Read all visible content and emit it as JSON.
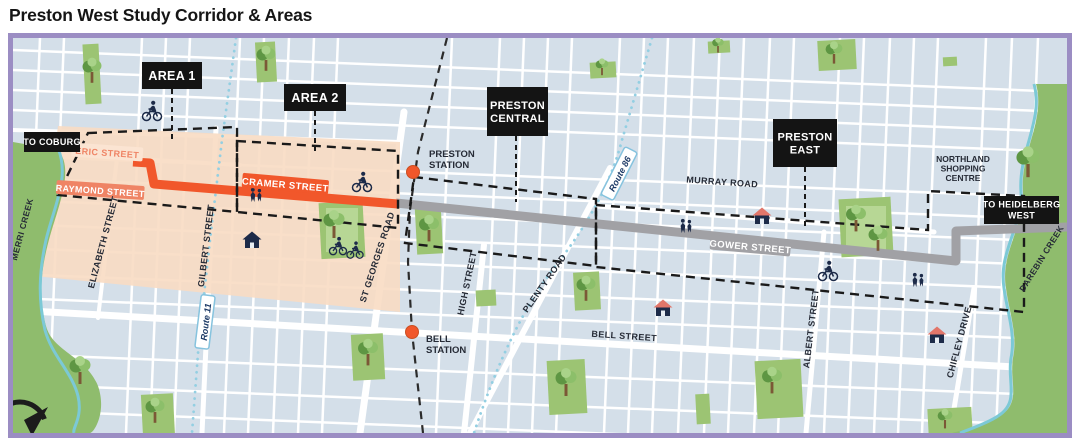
{
  "title": "Preston West Study Corridor & Areas",
  "theme": {
    "map_border": "#9b8dc3",
    "map_background": "#d4dfe9",
    "street_white": "#ffffff",
    "study_area_peach": "#f8dcc3",
    "corridor_orange": "#f1572b",
    "corridor_gray": "#a1a1a5",
    "park_green": "#9cc473",
    "park_green_light": "#b7d795",
    "creek_teal": "#7cc9d6",
    "label_box_bg": "#141414",
    "label_box_text": "#ffffff",
    "street_label_text": "#262b36",
    "route_label_text": "#1d3a66",
    "route_pill_border": "#86c3de",
    "station_dot": "#f1572b",
    "icon_navy": "#1d2b49"
  },
  "map": {
    "boxes": [
      {
        "name": "area-1-label",
        "lines": [
          "AREA 1"
        ],
        "x": 142,
        "y": 62,
        "w": 60,
        "h": 27,
        "fs": 12.5,
        "leader": [
          172,
          89,
          172,
          140
        ]
      },
      {
        "name": "area-2-label",
        "lines": [
          "AREA 2"
        ],
        "x": 284,
        "y": 84,
        "w": 62,
        "h": 27,
        "fs": 12.5,
        "leader": [
          315,
          111,
          315,
          151
        ]
      },
      {
        "name": "preston-central-label",
        "lines": [
          "PRESTON",
          "CENTRAL"
        ],
        "x": 487,
        "y": 87,
        "w": 61,
        "h": 49,
        "fs": 11,
        "leader": [
          516,
          136,
          516,
          202
        ]
      },
      {
        "name": "preston-east-label",
        "lines": [
          "PRESTON",
          "EAST"
        ],
        "x": 773,
        "y": 119,
        "w": 64,
        "h": 48,
        "fs": 11,
        "leader": [
          805,
          167,
          805,
          228
        ]
      },
      {
        "name": "to-coburg-label",
        "lines": [
          "TO COBURG"
        ],
        "x": 24,
        "y": 132,
        "w": 56,
        "h": 20,
        "fs": 9
      },
      {
        "name": "to-heidelberg-west-label",
        "lines": [
          "TO HEIDELBERG",
          "WEST"
        ],
        "x": 984,
        "y": 196,
        "w": 75,
        "h": 28,
        "fs": 9
      }
    ],
    "street_labels": [
      {
        "name": "eric-street-label",
        "text": "ERIC STREET",
        "x": 107,
        "y": 156,
        "rot": 4,
        "style": "orangeText"
      },
      {
        "name": "raymond-street-label",
        "text": "RAYMOND STREET",
        "x": 100,
        "y": 194,
        "rot": 4,
        "style": "orangePill"
      },
      {
        "name": "cramer-street-label",
        "text": "CRAMER STREET",
        "x": 285,
        "y": 188,
        "rot": 5,
        "style": "onOrange"
      },
      {
        "name": "gower-street-label",
        "text": "GOWER STREET",
        "x": 750,
        "y": 250,
        "rot": 5,
        "style": "onGray"
      },
      {
        "name": "murray-road-label",
        "text": "MURRAY ROAD",
        "x": 722,
        "y": 185,
        "rot": 4,
        "style": "dark"
      },
      {
        "name": "bell-street-label",
        "text": "BELL STREET",
        "x": 624,
        "y": 339,
        "rot": 4,
        "style": "dark"
      },
      {
        "name": "elizabeth-street-label",
        "text": "ELIZABETH STREET",
        "x": 106,
        "y": 243,
        "rot": -75,
        "style": "dark"
      },
      {
        "name": "gilbert-street-label",
        "text": "GILBERT STREET",
        "x": 209,
        "y": 246,
        "rot": -83,
        "style": "dark"
      },
      {
        "name": "st-georges-road-label",
        "text": "ST GEORGES ROAD",
        "x": 380,
        "y": 258,
        "rot": -72,
        "style": "dark"
      },
      {
        "name": "high-street-label",
        "text": "HIGH STREET",
        "x": 470,
        "y": 284,
        "rot": -78,
        "style": "dark"
      },
      {
        "name": "plenty-road-label",
        "text": "PLENTY ROAD",
        "x": 547,
        "y": 285,
        "rot": -55,
        "style": "dark"
      },
      {
        "name": "albert-street-label",
        "text": "ALBERT STREET",
        "x": 814,
        "y": 329,
        "rot": -83,
        "style": "dark"
      },
      {
        "name": "chifley-drive-label",
        "text": "CHIFLEY DRIVE",
        "x": 962,
        "y": 343,
        "rot": -75,
        "style": "dark"
      },
      {
        "name": "merri-creek-label",
        "text": "MERRI CREEK",
        "x": 25,
        "y": 230,
        "rot": -75,
        "style": "creek"
      },
      {
        "name": "darebin-creek-label",
        "text": "DAREBIN CREEK",
        "x": 1044,
        "y": 260,
        "rot": -58,
        "style": "creek"
      }
    ],
    "route_labels": [
      {
        "name": "route-11-label",
        "text": "Route 11",
        "x": 206,
        "y": 322,
        "rot": -83
      },
      {
        "name": "route-86-label",
        "text": "Route 86",
        "x": 620,
        "y": 174,
        "rot": -63
      }
    ],
    "stations": [
      {
        "name": "preston-station",
        "lines": [
          "PRESTON",
          "STATION"
        ],
        "dot": [
          413,
          172
        ],
        "tx": 429,
        "ty": 157
      },
      {
        "name": "bell-station",
        "lines": [
          "BELL",
          "STATION"
        ],
        "dot": [
          412,
          332
        ],
        "tx": 426,
        "ty": 342
      }
    ],
    "places": [
      {
        "name": "northland-shopping-centre-label",
        "lines": [
          "NORTHLAND",
          "SHOPPING",
          "CENTRE"
        ],
        "x": 963,
        "y": 162
      }
    ],
    "corridors": [
      {
        "name": "cramer-street-corridor",
        "color": "#f1572b"
      },
      {
        "name": "gower-street-corridor",
        "color": "#a1a1a5"
      }
    ],
    "icons": [
      {
        "name": "cyclist-icon",
        "x": 152,
        "y": 112,
        "s": 1
      },
      {
        "name": "cyclist-icon",
        "x": 362,
        "y": 183,
        "s": 1
      },
      {
        "name": "cyclist-icon",
        "x": 828,
        "y": 272,
        "s": 1
      },
      {
        "name": "cyclist-icon",
        "x": 338,
        "y": 247,
        "s": 0.9
      },
      {
        "name": "cyclist-icon",
        "x": 355,
        "y": 251,
        "s": 0.85
      },
      {
        "name": "pedestrians-icon",
        "x": 256,
        "y": 196,
        "s": 1
      },
      {
        "name": "pedestrians-icon",
        "x": 686,
        "y": 227,
        "s": 1
      },
      {
        "name": "pedestrians-icon",
        "x": 918,
        "y": 281,
        "s": 1
      },
      {
        "name": "house-icon",
        "x": 252,
        "y": 240,
        "s": 1
      },
      {
        "name": "house-icon",
        "x": 762,
        "y": 216,
        "s": 1,
        "variant": "red"
      },
      {
        "name": "house-icon",
        "x": 663,
        "y": 308,
        "s": 1,
        "variant": "red"
      },
      {
        "name": "house-icon",
        "x": 937,
        "y": 335,
        "s": 1,
        "variant": "red"
      },
      {
        "name": "tree-icon",
        "x": 92,
        "y": 72,
        "s": 0.9
      },
      {
        "name": "tree-icon",
        "x": 266,
        "y": 60,
        "s": 0.9
      },
      {
        "name": "tree-icon",
        "x": 334,
        "y": 226,
        "s": 1
      },
      {
        "name": "tree-icon",
        "x": 429,
        "y": 230,
        "s": 0.95
      },
      {
        "name": "tree-icon",
        "x": 602,
        "y": 68,
        "s": 0.6
      },
      {
        "name": "tree-icon",
        "x": 834,
        "y": 54,
        "s": 0.8
      },
      {
        "name": "tree-icon",
        "x": 718,
        "y": 46,
        "s": 0.55
      },
      {
        "name": "tree-icon",
        "x": 856,
        "y": 220,
        "s": 0.95
      },
      {
        "name": "tree-icon",
        "x": 878,
        "y": 240,
        "s": 0.9
      },
      {
        "name": "tree-icon",
        "x": 586,
        "y": 290,
        "s": 0.9
      },
      {
        "name": "tree-icon",
        "x": 566,
        "y": 384,
        "s": 1
      },
      {
        "name": "tree-icon",
        "x": 368,
        "y": 354,
        "s": 0.95
      },
      {
        "name": "tree-icon",
        "x": 80,
        "y": 372,
        "s": 1
      },
      {
        "name": "tree-icon",
        "x": 1028,
        "y": 164,
        "s": 1.1
      },
      {
        "name": "tree-icon",
        "x": 772,
        "y": 382,
        "s": 0.95
      },
      {
        "name": "tree-icon",
        "x": 155,
        "y": 412,
        "s": 0.9
      },
      {
        "name": "tree-icon",
        "x": 945,
        "y": 420,
        "s": 0.7
      },
      {
        "name": "compass-icon",
        "x": 20,
        "y": 428,
        "s": 1
      }
    ]
  }
}
